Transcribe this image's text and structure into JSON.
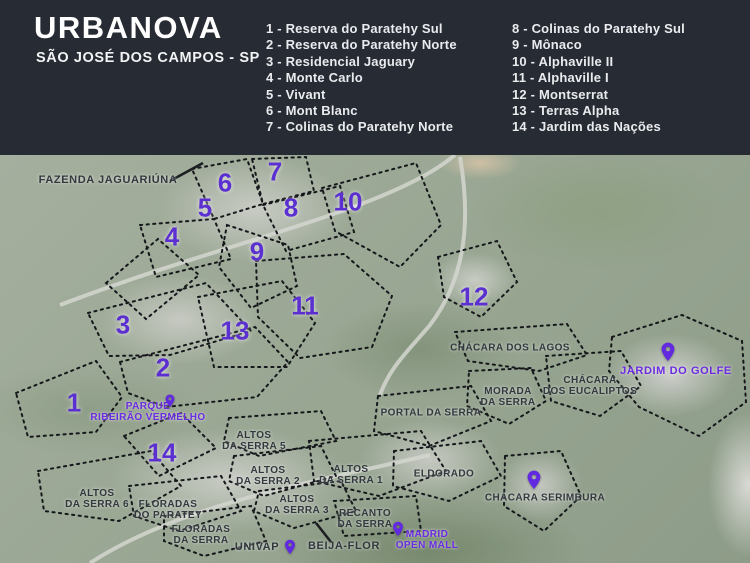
{
  "header": {
    "title": "URBANOVA",
    "subtitle": "SÃO JOSÉ DOS CAMPOS - SP",
    "legend_col1": [
      "1 - Reserva do Paratehy Sul",
      "2 - Reserva do Paratehy Norte",
      "3 - Residencial Jaguary",
      "4 - Monte Carlo",
      "5 - Vivant",
      "6 - Mont Blanc",
      "7 - Colinas do Paratehy Norte"
    ],
    "legend_col2": [
      "8 - Colinas do Paratehy Sul",
      "9 - Mônaco",
      "10 - Alphaville II",
      "11 - Alphaville I",
      "12 - Montserrat",
      "13 - Terras Alpha",
      "14 - Jardim das Nações"
    ]
  },
  "map": {
    "markers": [
      "1",
      "2",
      "3",
      "4",
      "5",
      "6",
      "7",
      "8",
      "9",
      "10",
      "11",
      "12",
      "13",
      "14"
    ],
    "places": {
      "fazenda": "FAZENDA JAGUARIÚNA",
      "chacara_lagos": "CHÁCARA DOS LAGOS",
      "jardim_golfe": "JARDIM DO GOLFE",
      "eucaliptos_l1": "CHÁCARA",
      "eucaliptos_l2": "DOS EUCALIPTOS",
      "morada_l1": "MORADA",
      "morada_l2": "DA SERRA",
      "portal": "PORTAL DA SERRA",
      "eldorado": "ELDORADO",
      "serimbura": "CHÁCARA SERIMBURA",
      "parque_l1": "PARQUE",
      "parque_l2": "RIBEIRÃO VERMELHO",
      "altos5_l1": "ALTOS",
      "altos5_l2": "DA SERRA 5",
      "altos2_l1": "ALTOS",
      "altos2_l2": "DA SERRA 2",
      "altos1_l1": "ALTOS",
      "altos1_l2": "DA SERRA 1",
      "altos3_l1": "ALTOS",
      "altos3_l2": "DA SERRA 3",
      "altos6_l1": "ALTOS",
      "altos6_l2": "DA SERRA 6",
      "floradas_p_l1": "FLORADAS",
      "floradas_p_l2": "DO PARATEY",
      "floradas_s_l1": "FLORADAS",
      "floradas_s_l2": "DA SERRA",
      "recanto_l1": "RECANTO",
      "recanto_l2": "DA SERRA",
      "univap": "UNIVAP",
      "beija_flor": "BEIJA-FLOR",
      "madrid_l1": "MADRID",
      "madrid_l2": "OPEN MALL"
    },
    "colors": {
      "header_bg": "#272b33",
      "number_purple": "#5b2fd0",
      "pin_purple": "#6129e0",
      "label_purple": "#6b2be0",
      "label_dark": "#33383e"
    }
  }
}
